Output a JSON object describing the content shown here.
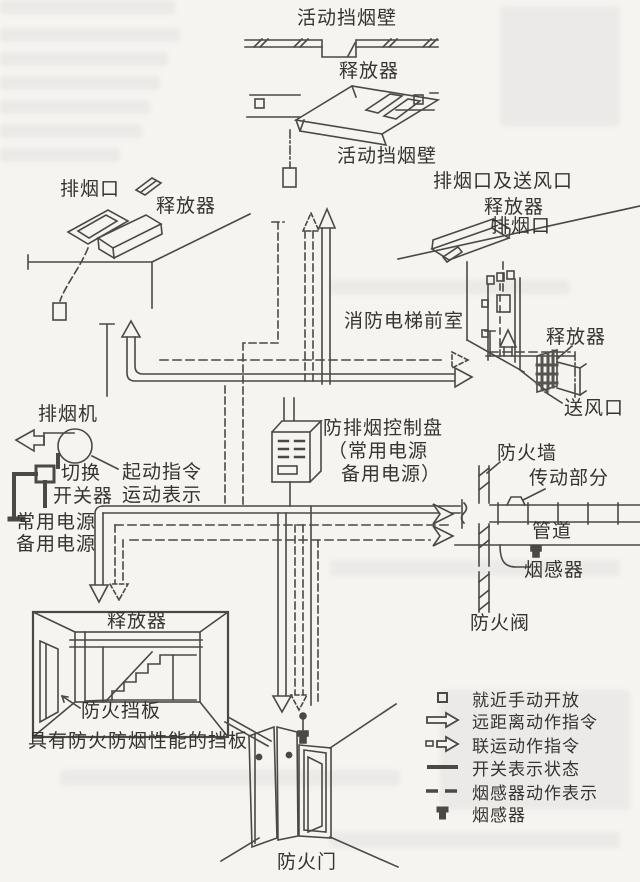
{
  "page": {
    "background": "#f5f4f0",
    "ink": "#44433f"
  },
  "labels": {
    "movable_smoke_barrier_top": "活动挡烟壁",
    "releaser_top": "释放器",
    "movable_smoke_barrier_mid": "活动挡烟壁",
    "smoke_vent_left": "排烟口",
    "releaser_left": "释放器",
    "smoke_and_supply_vent": "排烟口及送风口",
    "releaser_right_top": "释放器",
    "smoke_vent_right": "排烟口",
    "fire_elevator_lobby": "消防电梯前室",
    "releaser_far_right": "释放器",
    "air_supply_vent": "送风口",
    "smoke_exhaust_fan": "排烟机",
    "changeover_switch_line1": "切换",
    "changeover_switch_line2": "开关器",
    "start_command": "起动指令",
    "motion_indication": "运动表示",
    "normal_power": "常用电源",
    "backup_power": "备用电源",
    "control_panel_line1": "防排烟控制盘",
    "control_panel_line2": "（常用电源",
    "control_panel_line3": "备用电源）",
    "fire_wall": "防火墙",
    "transmission_part": "传动部分",
    "duct": "管道",
    "smoke_detector_on_duct": "烟感器",
    "fire_damper_valve": "防火阀",
    "releaser_room": "释放器",
    "fire_baffle": "防火挡板",
    "fire_smoke_baffle_caption": "具有防火防烟性能的挡板",
    "fire_door": "防火门"
  },
  "legend": {
    "items": [
      {
        "icon": "manual-open-square",
        "label": "就近手动开放"
      },
      {
        "icon": "solid-hollow-arrow",
        "label": "远距离动作指令"
      },
      {
        "icon": "dashed-hollow-arrow",
        "label": "联运动作指令"
      },
      {
        "icon": "solid-line",
        "label": "开关表示状态"
      },
      {
        "icon": "dashed-line",
        "label": "烟感器动作表示"
      },
      {
        "icon": "smoke-detector",
        "label": "烟感器"
      }
    ]
  }
}
